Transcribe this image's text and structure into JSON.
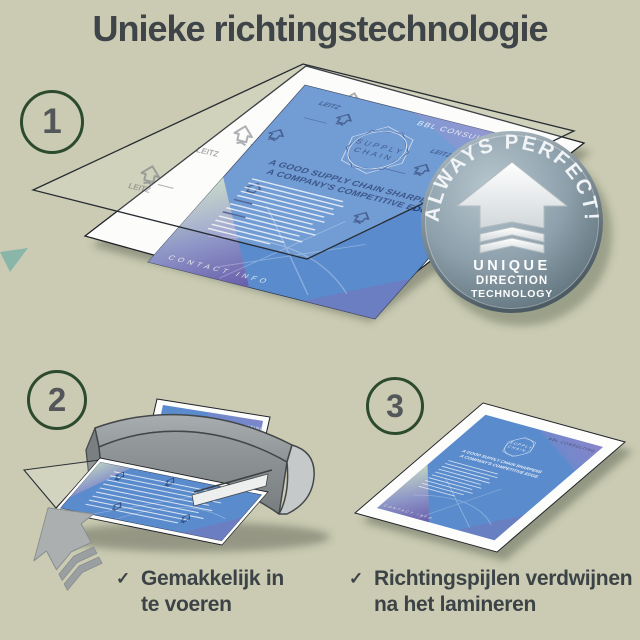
{
  "title": "Unieke richtingstechnologie",
  "steps": [
    {
      "number": "1"
    },
    {
      "number": "2"
    },
    {
      "number": "3"
    }
  ],
  "badge": {
    "arc_text": "ALWAYS PERFECT!",
    "line1": "UNIQUE",
    "line2": "DIRECTION",
    "line3": "TECHNOLOGY",
    "icon": "up-arrow-with-chevrons"
  },
  "document": {
    "brand": "BBL CONSULTING",
    "emblem_line1": "SUPPLY",
    "emblem_line2": "CHAIN",
    "headline_line1": "A GOOD SUPPLY CHAIN SHARPENS",
    "headline_line2": "A COMPANY'S COMPETITIVE EDGE.",
    "footer": "CONTACT INFO",
    "watermark": "LEITZ"
  },
  "bullets": [
    {
      "check": "✓",
      "line1": "Gemakkelijk in",
      "line2": "te voeren"
    },
    {
      "check": "✓",
      "line1": "Richtingspijlen verdwijnen",
      "line2": "na het lamineren"
    }
  ],
  "colors": {
    "background": "#cacbb2",
    "title": "#3e4448",
    "step_circle": "#2c4a2e",
    "step_number": "#53575a",
    "badge_face": "#8da0ab",
    "document_blue": "#5a8ccd",
    "machine_gray": "#8b9092",
    "text_dark": "#3c4347"
  }
}
